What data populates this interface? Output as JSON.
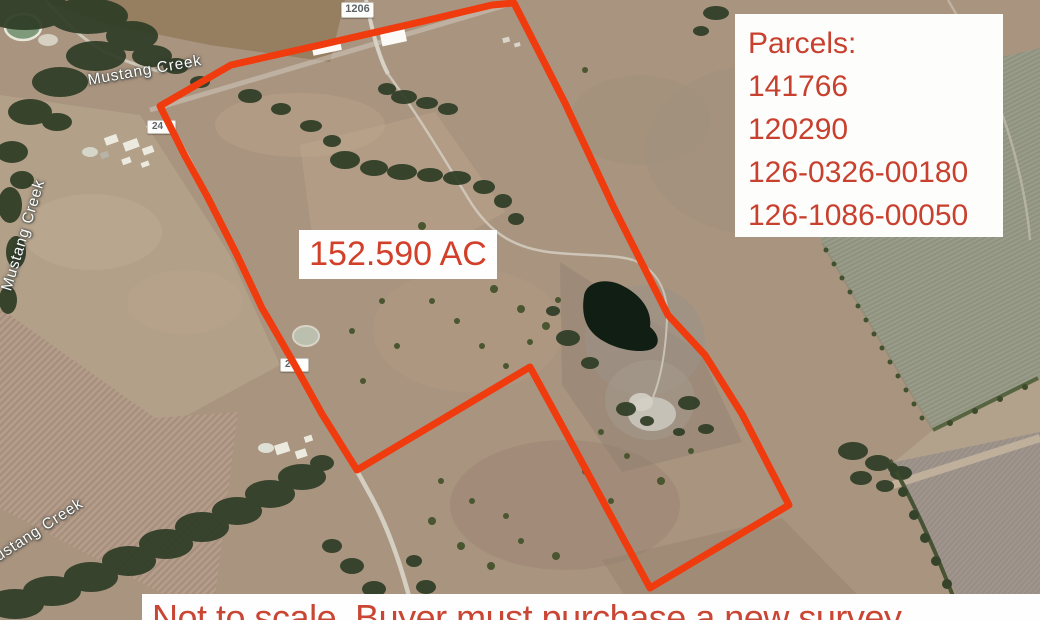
{
  "map": {
    "area_label": "152.590 AC",
    "parcels_box": {
      "title": "Parcels:",
      "parcels": [
        "141766",
        "120290",
        "126-0326-00180",
        "126-1086-00050"
      ]
    },
    "disclaimer": "Not to scale. Buyer must purchase a new survey",
    "labels": {
      "creek_top": "Mustang Creek",
      "creek_left": "Mustang Creek",
      "creek_bottom": "Mustang Creek",
      "road_shield_1206": "1206",
      "road_shield_24_upper": "24",
      "road_shield_24_lower": "24"
    },
    "colors": {
      "boundary_red": "#ef3b0e",
      "annotation_red": "#c8402e",
      "overlay_background": "#fdfdfc"
    }
  }
}
